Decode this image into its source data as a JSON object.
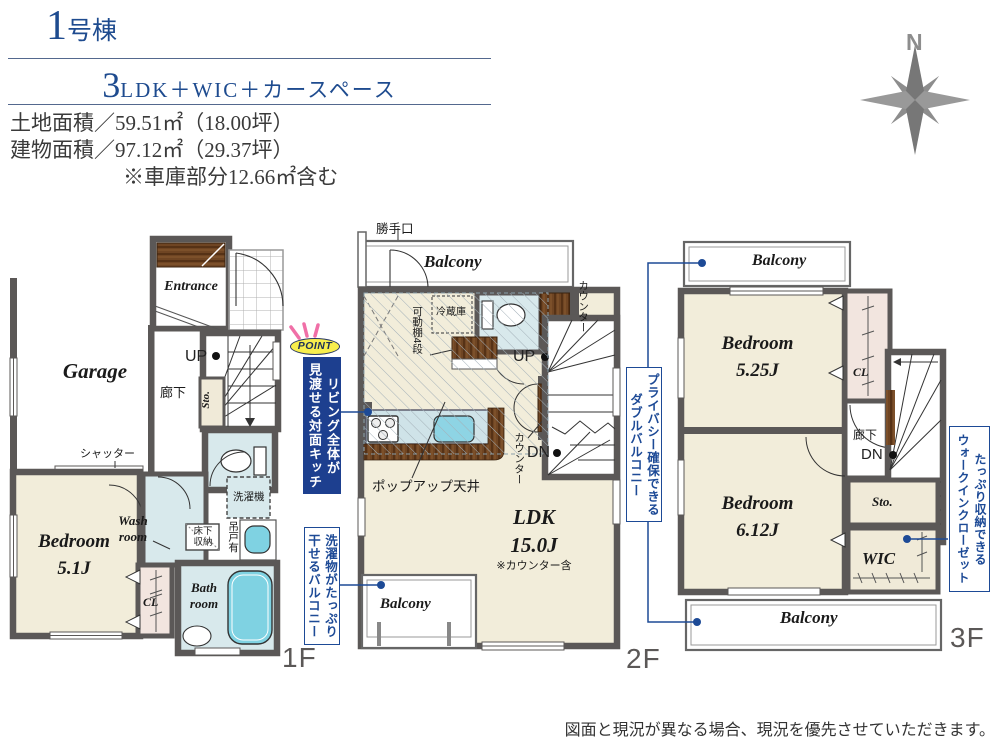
{
  "colors": {
    "accent_blue": "#1d4a96",
    "title_navy": "#1e4b8f",
    "wall_gray": "#5b5857",
    "floor_cream": "#f2edda",
    "water_blue": "#d8e9ec",
    "fixture_aqua": "#7fd2e2",
    "closet_pink": "#f2e5df",
    "wood_brown": "#6f4523",
    "point_yellow": "#f7ee4d",
    "ray_pink": "#f06fa7",
    "label_gray": "#5b5857"
  },
  "header": {
    "building_number": "1",
    "building_unit": "号棟",
    "plan_number": "3",
    "plan_text": "LDK＋WIC＋カースペース",
    "land_area": "土地面積／59.51㎡（18.00坪）",
    "building_area": "建物面積／97.12㎡（29.37坪）",
    "garage_note": "※車庫部分12.66㎡含む"
  },
  "compass": {
    "north": "N"
  },
  "floor1": {
    "name": "1F",
    "garage": "Garage",
    "entrance": "Entrance",
    "bedroom": "Bedroom\n5.1J",
    "wash_room": "Wash\nroom",
    "bath_room": "Bath\nroom",
    "cl": "CL",
    "sto": "Sto.",
    "hallway": "廊下",
    "up": "UP",
    "shutter": "シャッター",
    "washer": "洗濯機",
    "underfloor_storage": "床下\n収納",
    "hanging_cabinet": "吊戸有"
  },
  "floor2": {
    "name": "2F",
    "back_door": "勝手口",
    "balcony_top": "Balcony",
    "balcony_bottom": "Balcony",
    "fridge": "冷蔵庫",
    "movable_shelf": "可動棚4段",
    "counter_top": "カウンター",
    "counter_mid": "カウンター",
    "up": "UP",
    "dn": "DN",
    "popup_ceiling": "ポップアップ天井",
    "ldk": "LDK\n15.0J",
    "ldk_note": "※カウンター含"
  },
  "floor3": {
    "name": "3F",
    "balcony_top": "Balcony",
    "balcony_bottom": "Balcony",
    "bedroom_1": "Bedroom\n5.25J",
    "bedroom_2": "Bedroom\n6.12J",
    "cl": "CL",
    "hallway": "廊下",
    "dn": "DN",
    "sto": "Sto.",
    "wic": "WIC"
  },
  "callouts": {
    "point_badge": "POINT",
    "kitchen": "リビング全体が\n見渡せる対面キッチン",
    "laundry": "洗濯物がたっぷり\n干せるバルコニー",
    "privacy": "プライバシー確保できる\nダブルバルコニー",
    "wic": "たっぷり収納できる\nウォークインクローゼット"
  },
  "footer": {
    "disclaimer": "図面と現況が異なる場合、現況を優先させていただきます。"
  }
}
